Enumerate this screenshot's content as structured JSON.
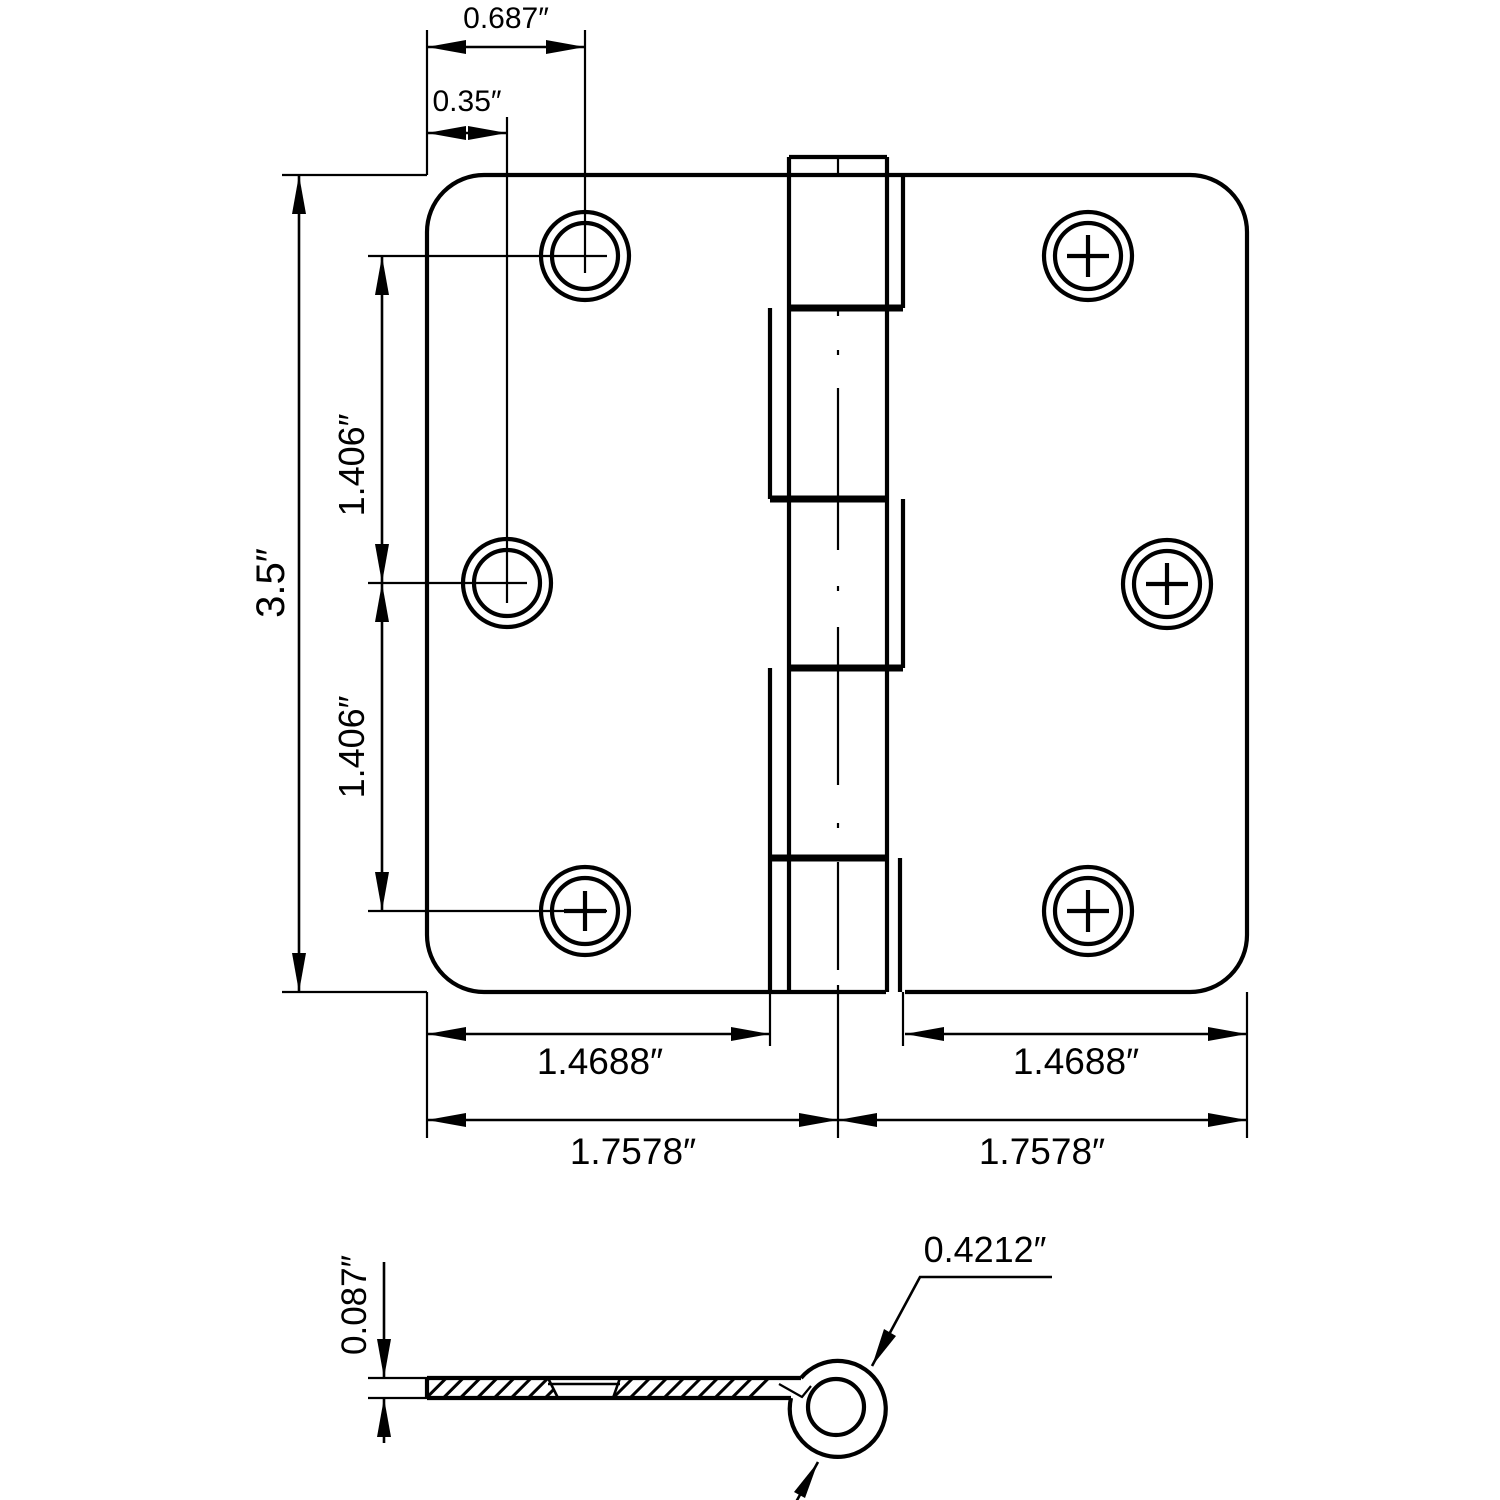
{
  "style": {
    "line_color": "#000000",
    "background": "#ffffff"
  },
  "front_view": {
    "dims": {
      "hole1_offset_x": "0.687″",
      "hole2_offset_x": "0.35″",
      "overall_height": "3.5″",
      "hole_spacing_upper": "1.406″",
      "hole_spacing_lower": "1.406″",
      "leaf_width_left": "1.4688″",
      "leaf_width_right": "1.4688″",
      "half_width_left": "1.7578″",
      "half_width_right": "1.7578″"
    }
  },
  "section_view": {
    "dims": {
      "leaf_thickness": "0.087″",
      "knuckle_diameter": "0.4212″"
    }
  }
}
